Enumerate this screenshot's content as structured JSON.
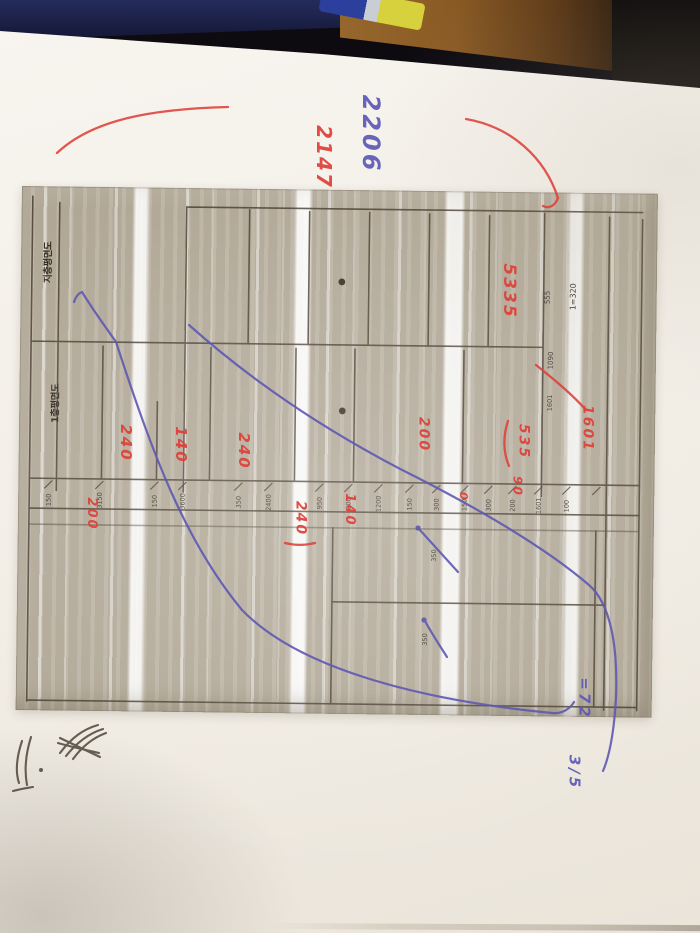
{
  "scene_colors": {
    "paper": "#f2eee6",
    "photocopy_bg": "#b4ab9a",
    "plan_line": "#44392b",
    "red_ink": "#de4038",
    "purple_ink": "#5f59b3",
    "black_ink": "#4d463a",
    "desk_wood": "#8a5a24",
    "desk_navy": "#252c5c",
    "pen_blue": "#2c3f9c",
    "pen_yellow": "#d6d13c"
  },
  "printed": {
    "titles": [
      {
        "name": "plan-title-upper",
        "text": "지층평면도"
      },
      {
        "name": "plan-title-lower",
        "text": "1층평면도"
      }
    ],
    "scale_note": "1=320",
    "small_numbers": {
      "n555": "555",
      "n1090": "1090",
      "n1601": "1601",
      "n350a": "350",
      "n350b": "350"
    },
    "dimension_row": [
      "150",
      "3150",
      "150",
      "3600",
      "350",
      "2400",
      "950",
      "300",
      "1200",
      "150",
      "300",
      "150",
      "300",
      "200",
      "1601",
      "100"
    ]
  },
  "ink": {
    "red": [
      {
        "name": "top-margin-note",
        "text": "2147"
      },
      {
        "name": "area-note",
        "text": "5335"
      },
      {
        "name": "room-dim-1",
        "text": "240"
      },
      {
        "name": "room-dim-2",
        "text": "140"
      },
      {
        "name": "room-dim-3",
        "text": "240"
      },
      {
        "name": "dim-200-upper",
        "text": "200"
      },
      {
        "name": "dim-535",
        "text": "535"
      },
      {
        "name": "dim-90",
        "text": "90"
      },
      {
        "name": "dim-1601",
        "text": "1601"
      },
      {
        "name": "dim-200-left",
        "text": "200"
      },
      {
        "name": "dim-240-lower",
        "text": "240"
      },
      {
        "name": "dim-140-lower",
        "text": "140"
      },
      {
        "name": "dim-0",
        "text": "0"
      }
    ],
    "blue": [
      {
        "name": "top-margin-note",
        "text": "2206"
      },
      {
        "name": "bottom-note-upper",
        "text": "=72"
      },
      {
        "name": "bottom-note-lower",
        "text": "3/5"
      }
    ],
    "black": [
      {
        "name": "corner-scribble-1",
        "text": "(illegible)"
      },
      {
        "name": "corner-scribble-2",
        "text": "(illegible)"
      }
    ]
  }
}
